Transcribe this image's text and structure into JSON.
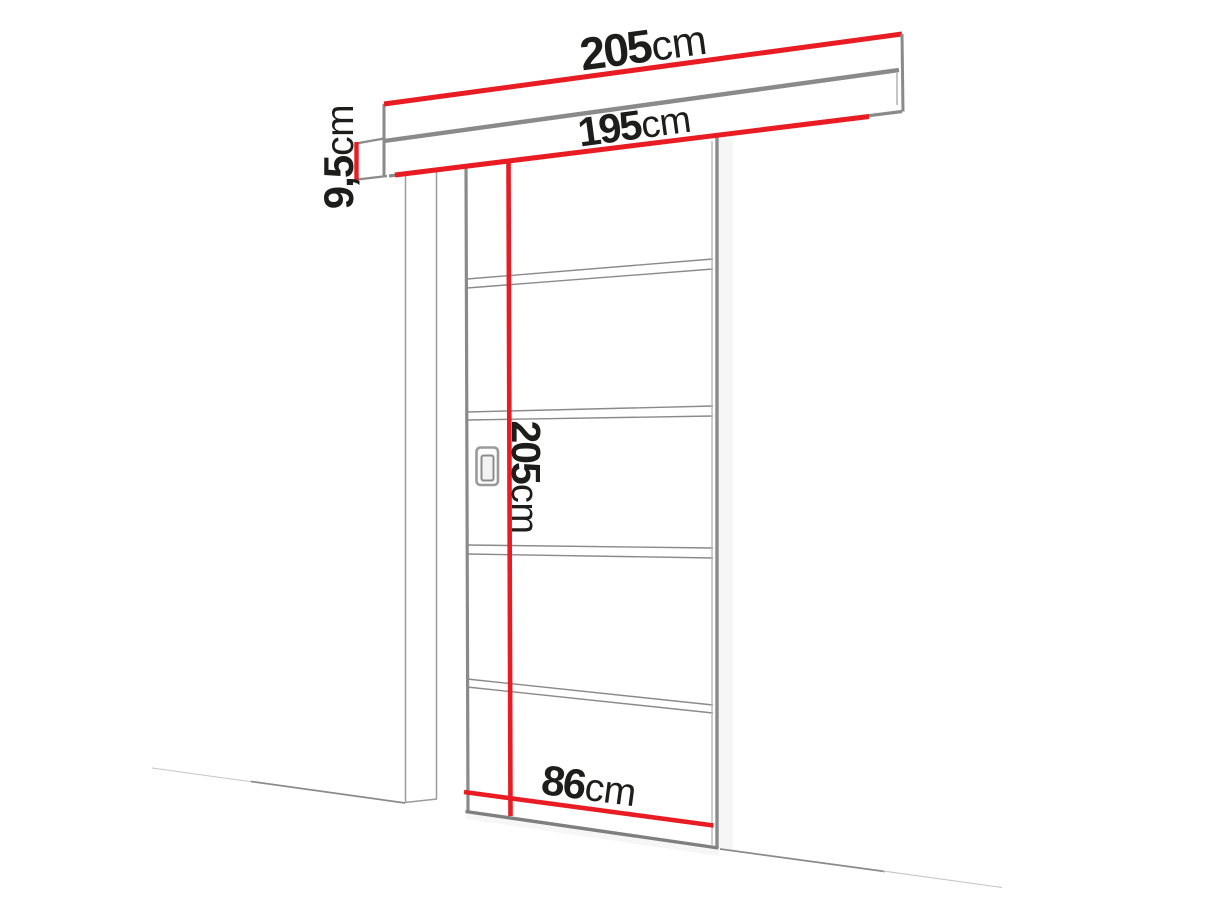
{
  "diagram": {
    "title": "sliding-door-dimension-diagram",
    "labels": {
      "track_width": {
        "value": "205",
        "unit": "cm"
      },
      "passage_width": {
        "value": "195",
        "unit": "cm"
      },
      "track_height": {
        "value": "9,5",
        "unit": "cm"
      },
      "door_height": {
        "value": "205",
        "unit": "cm"
      },
      "door_width": {
        "value": "86",
        "unit": "cm"
      }
    },
    "colors": {
      "dimension_red": "#e81c22",
      "line_gray": "#8a8a8a",
      "frame_thin_gray": "#9c9c9c",
      "text": "#1d1d1b",
      "background": "#ffffff"
    }
  }
}
